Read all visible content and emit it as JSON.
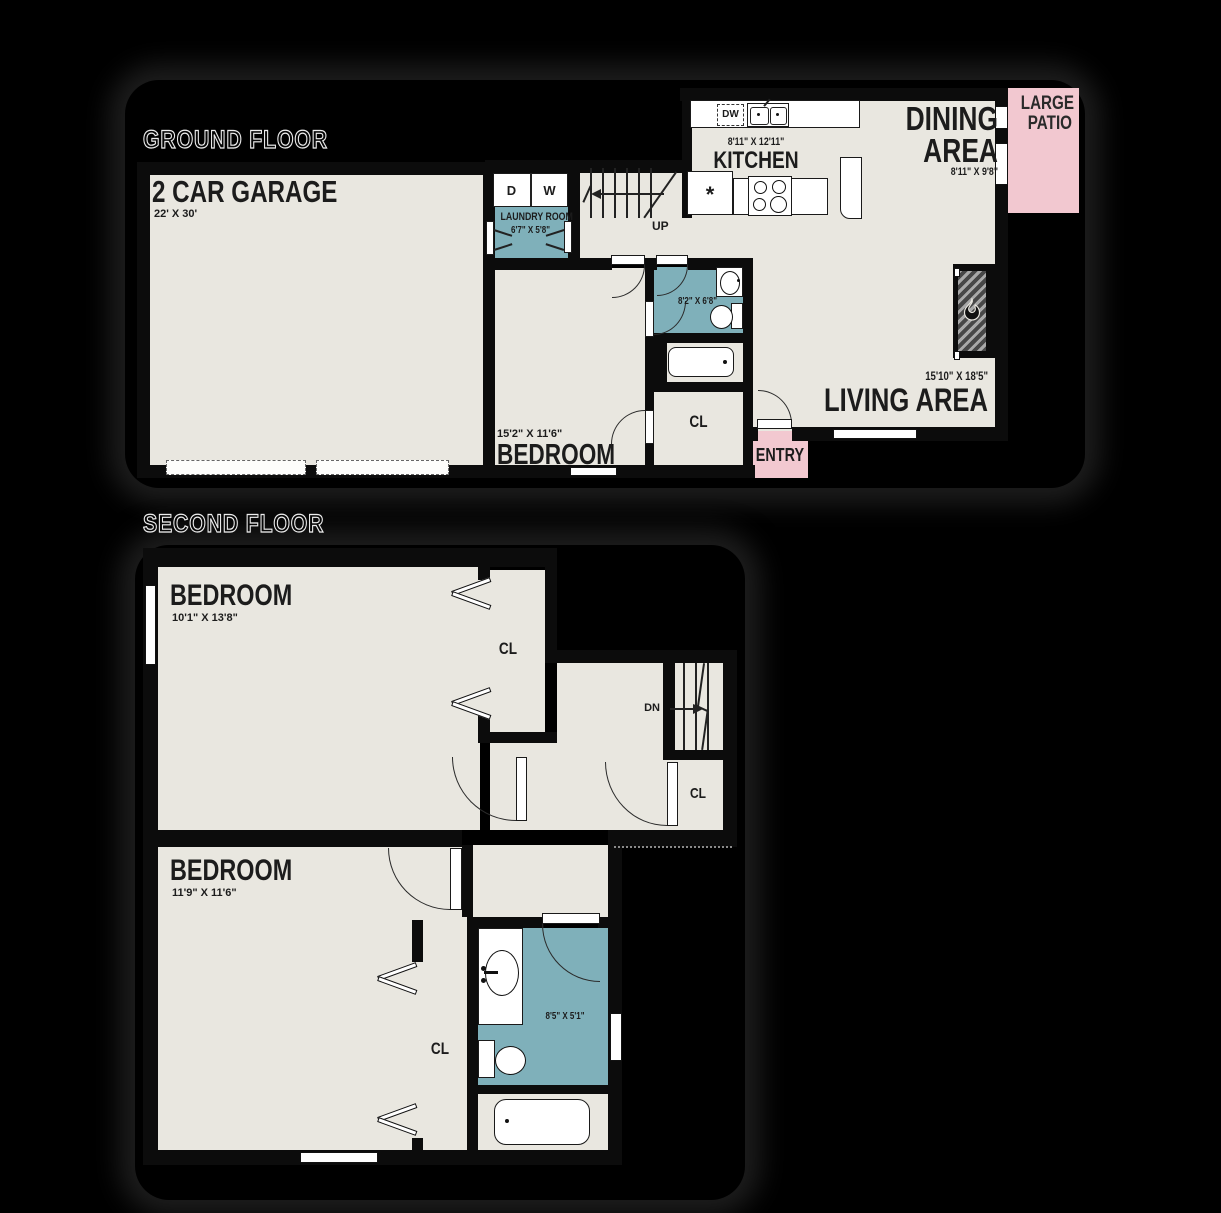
{
  "ground_floor": {
    "title": "GROUND FLOOR",
    "garage": {
      "label": "2 CAR GARAGE",
      "dims": "22' X 30'"
    },
    "laundry": {
      "label": "LAUNDRY ROOM",
      "dims": "6'7\" X 5'8\"",
      "dryer": "D",
      "washer": "W"
    },
    "kitchen": {
      "label": "KITCHEN",
      "dims": "8'11\" X 12'11\"",
      "dishwasher": "DW",
      "fridge_symbol": "*"
    },
    "dining": {
      "label_line1": "DINING",
      "label_line2": "AREA",
      "dims": "8'11\" X 9'8\""
    },
    "patio": {
      "label_line1": "LARGE",
      "label_line2": "PATIO"
    },
    "living": {
      "label": "LIVING AREA",
      "dims": "15'10\" X 18'5\""
    },
    "bedroom": {
      "label": "BEDROOM",
      "dims": "15'2\" X 11'6\""
    },
    "bathroom": {
      "dims": "8'2\" X 6'8\""
    },
    "closet": {
      "label": "CL"
    },
    "entry": {
      "label": "ENTRY"
    },
    "stairs": {
      "label": "UP"
    }
  },
  "second_floor": {
    "title": "SECOND FLOOR",
    "bedroom1": {
      "label": "BEDROOM",
      "dims": "10'1\" X 13'8\""
    },
    "closet1": {
      "label": "CL"
    },
    "stairs": {
      "label": "DN"
    },
    "closet2": {
      "label": "CL"
    },
    "bedroom2": {
      "label": "BEDROOM",
      "dims": "11'9\" X 11'6\""
    },
    "closet3": {
      "label": "CL"
    },
    "bathroom": {
      "dims": "8'5\" X 5'1\""
    }
  },
  "colors": {
    "floor": "#e9e7e0",
    "wet_room": "#7fb0ba",
    "outdoor": "#f2c8d0",
    "wall": "#0c0c0c",
    "background": "#000000"
  }
}
